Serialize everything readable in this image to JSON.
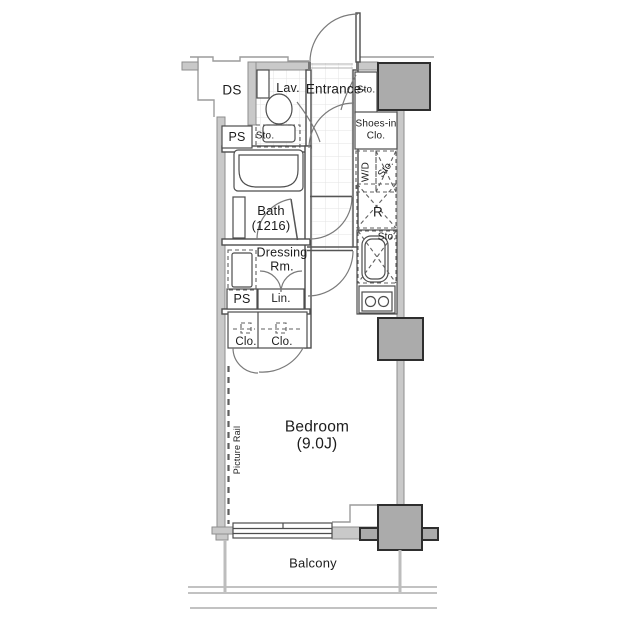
{
  "labels": {
    "ds": "DS",
    "ps_top": "PS",
    "lav": "Lav.",
    "lav_storage": "Sto.",
    "entrance": "Entrance-",
    "entrance_storage": "Sto.",
    "shoes_closet_line1": "Shoes-in",
    "shoes_closet_line2": "Clo.",
    "washer_dryer": "W/D",
    "washer_storage": "Sto.",
    "bath_name": "Bath",
    "bath_size": "(1216)",
    "refrigerator": "R",
    "kitchen_storage": "Sto.",
    "dressing_line1": "Dressing",
    "dressing_line2": "Rm.",
    "linen": "Lin.",
    "ps_bottom": "PS",
    "closet_left": "Clo.",
    "closet_right": "Clo.",
    "picture_rail": "Picture Rail",
    "bedroom_name": "Bedroom",
    "bedroom_size": "(9.0J)",
    "balcony": "Balcony"
  },
  "colors": {
    "wall_fill": "#c9c9c9",
    "wall_stroke": "#8e8e8e",
    "column_fill": "#ababab",
    "column_stroke": "#2e2e2e",
    "partition_stroke": "#4d4d4d",
    "door_stroke": "#7a7a7a",
    "thin_stroke": "#9c9c9c",
    "tile_stroke": "#e3e3e3",
    "dash_stroke": "#5f5f5f",
    "text_color": "#1c1c1c"
  }
}
